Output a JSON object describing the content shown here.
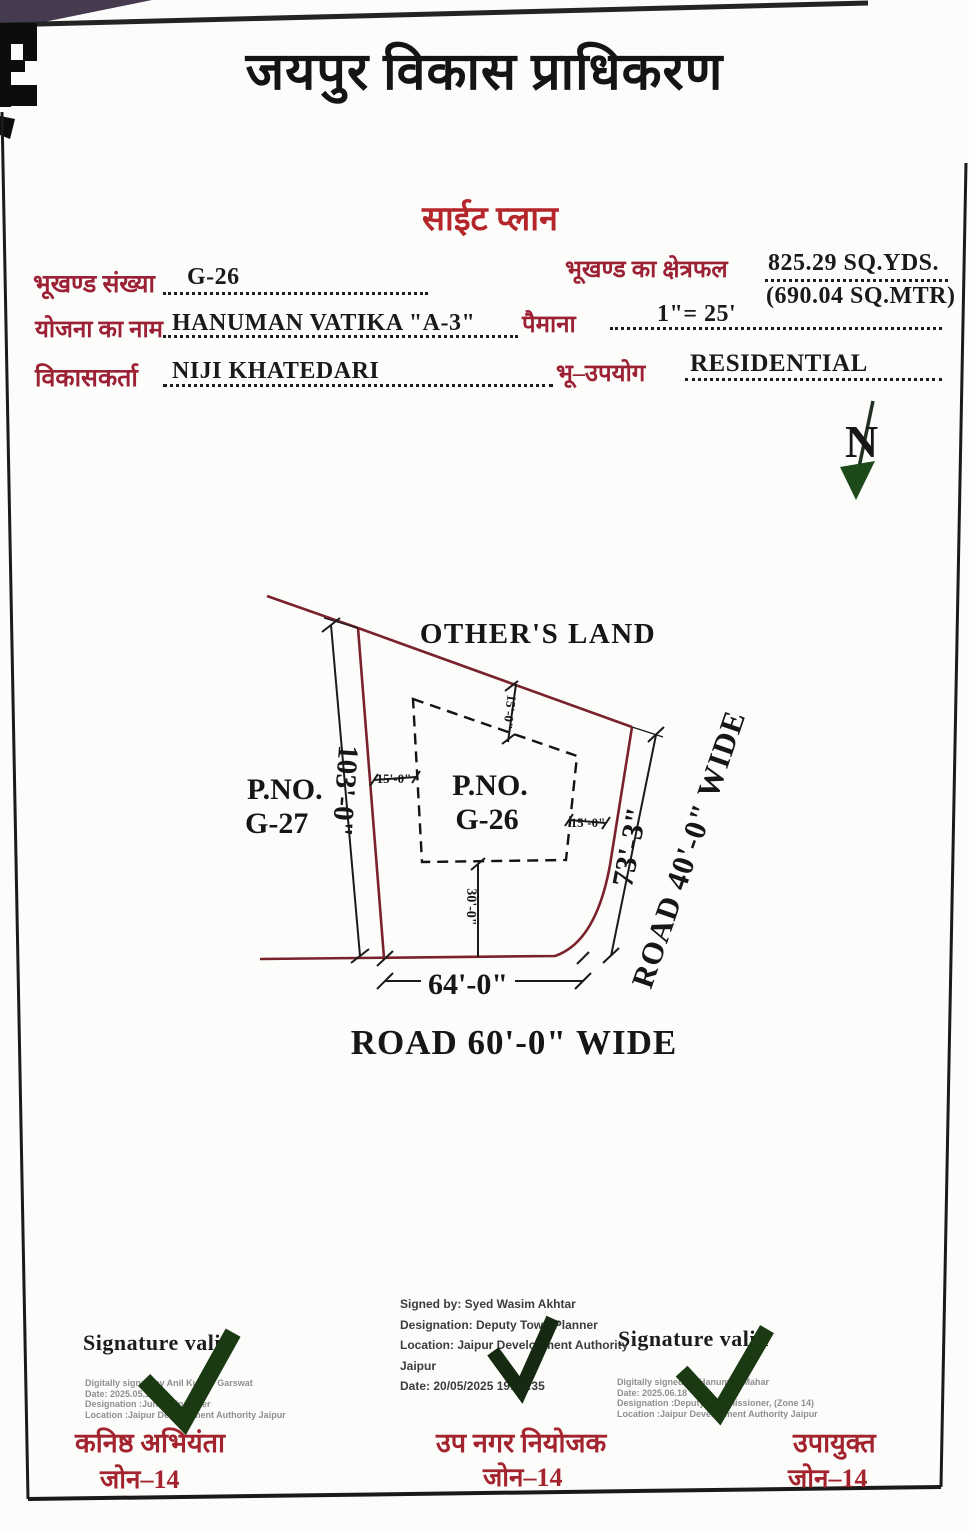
{
  "page": {
    "authority_name": "जयपुर विकास प्राधिकरण",
    "document_title": "साईट प्लान"
  },
  "form": {
    "plot_number": {
      "label": "भूखण्ड संख्या",
      "value": "G-26"
    },
    "plot_area": {
      "label": "भूखण्ड का क्षेत्रफल",
      "value": "825.29 SQ.YDS.",
      "value2": "(690.04 SQ.MTR)"
    },
    "scheme_name": {
      "label": "योजना का नाम",
      "value": "HANUMAN VATIKA \"A-3\""
    },
    "scale": {
      "label": "पैमाना",
      "value": "1\"= 25'"
    },
    "developer": {
      "label": "विकासकर्ता",
      "value": "NIJI KHATEDARI"
    },
    "land_use": {
      "label": "भू–उपयोग",
      "value": "RESIDENTIAL"
    }
  },
  "plan": {
    "north_label": "N",
    "others_land_label": "OTHER'S LAND",
    "adjacent_plot": {
      "line1": "P.NO.",
      "line2": "G-27"
    },
    "subject_plot": {
      "line1": "P.NO.",
      "line2": "G-26"
    },
    "dimensions": {
      "west_boundary": "103'-0\"",
      "east_boundary": "73'-3\"",
      "south_boundary": "64'-0\"",
      "setback_north": "15'-0\"",
      "setback_west": "15'-0\"",
      "setback_east": "15'-0\"",
      "setback_south": "30'-0\""
    },
    "road_east_label": "ROAD 40'-0\" WIDE",
    "road_south_label": "ROAD 60'-0\" WIDE"
  },
  "signatures": {
    "left": {
      "valid_text": "Signature valid",
      "lines": [
        "Digitally signed by Anil Kumar Garswat",
        "Date: 2025.05.16",
        "Designation :Junior Engineer",
        "Location :Jaipur Development Authority Jaipur"
      ],
      "title_hi": "कनिष्ठ अभियंता",
      "zone": "जोन–14"
    },
    "center": {
      "lines": [
        "Signed by: Syed Wasim Akhtar",
        "Designation: Deputy Town Planner",
        "Location: Jaipur Development Authority",
        "Jaipur",
        "Date: 20/05/2025 19:37:35"
      ],
      "title_hi": "उप नगर नियोजक",
      "zone": "जोन–14"
    },
    "right": {
      "valid_text": "Signature valid",
      "lines": [
        "Digitally signed by Hanuman Mahar",
        "Date: 2025.06.18",
        "Designation :Deputy Commissioner, (Zone 14)",
        "Location :Jaipur Development Authority Jaipur"
      ],
      "title_hi": "उपायुक्त",
      "zone": "जोन–14"
    }
  },
  "colors": {
    "label_maroon": "#9c2134",
    "title_red": "#b5262b",
    "boundary_red": "#7a222c",
    "checkmark_green": "#1b3a14",
    "north_letter_red": "#9e1f2d"
  }
}
